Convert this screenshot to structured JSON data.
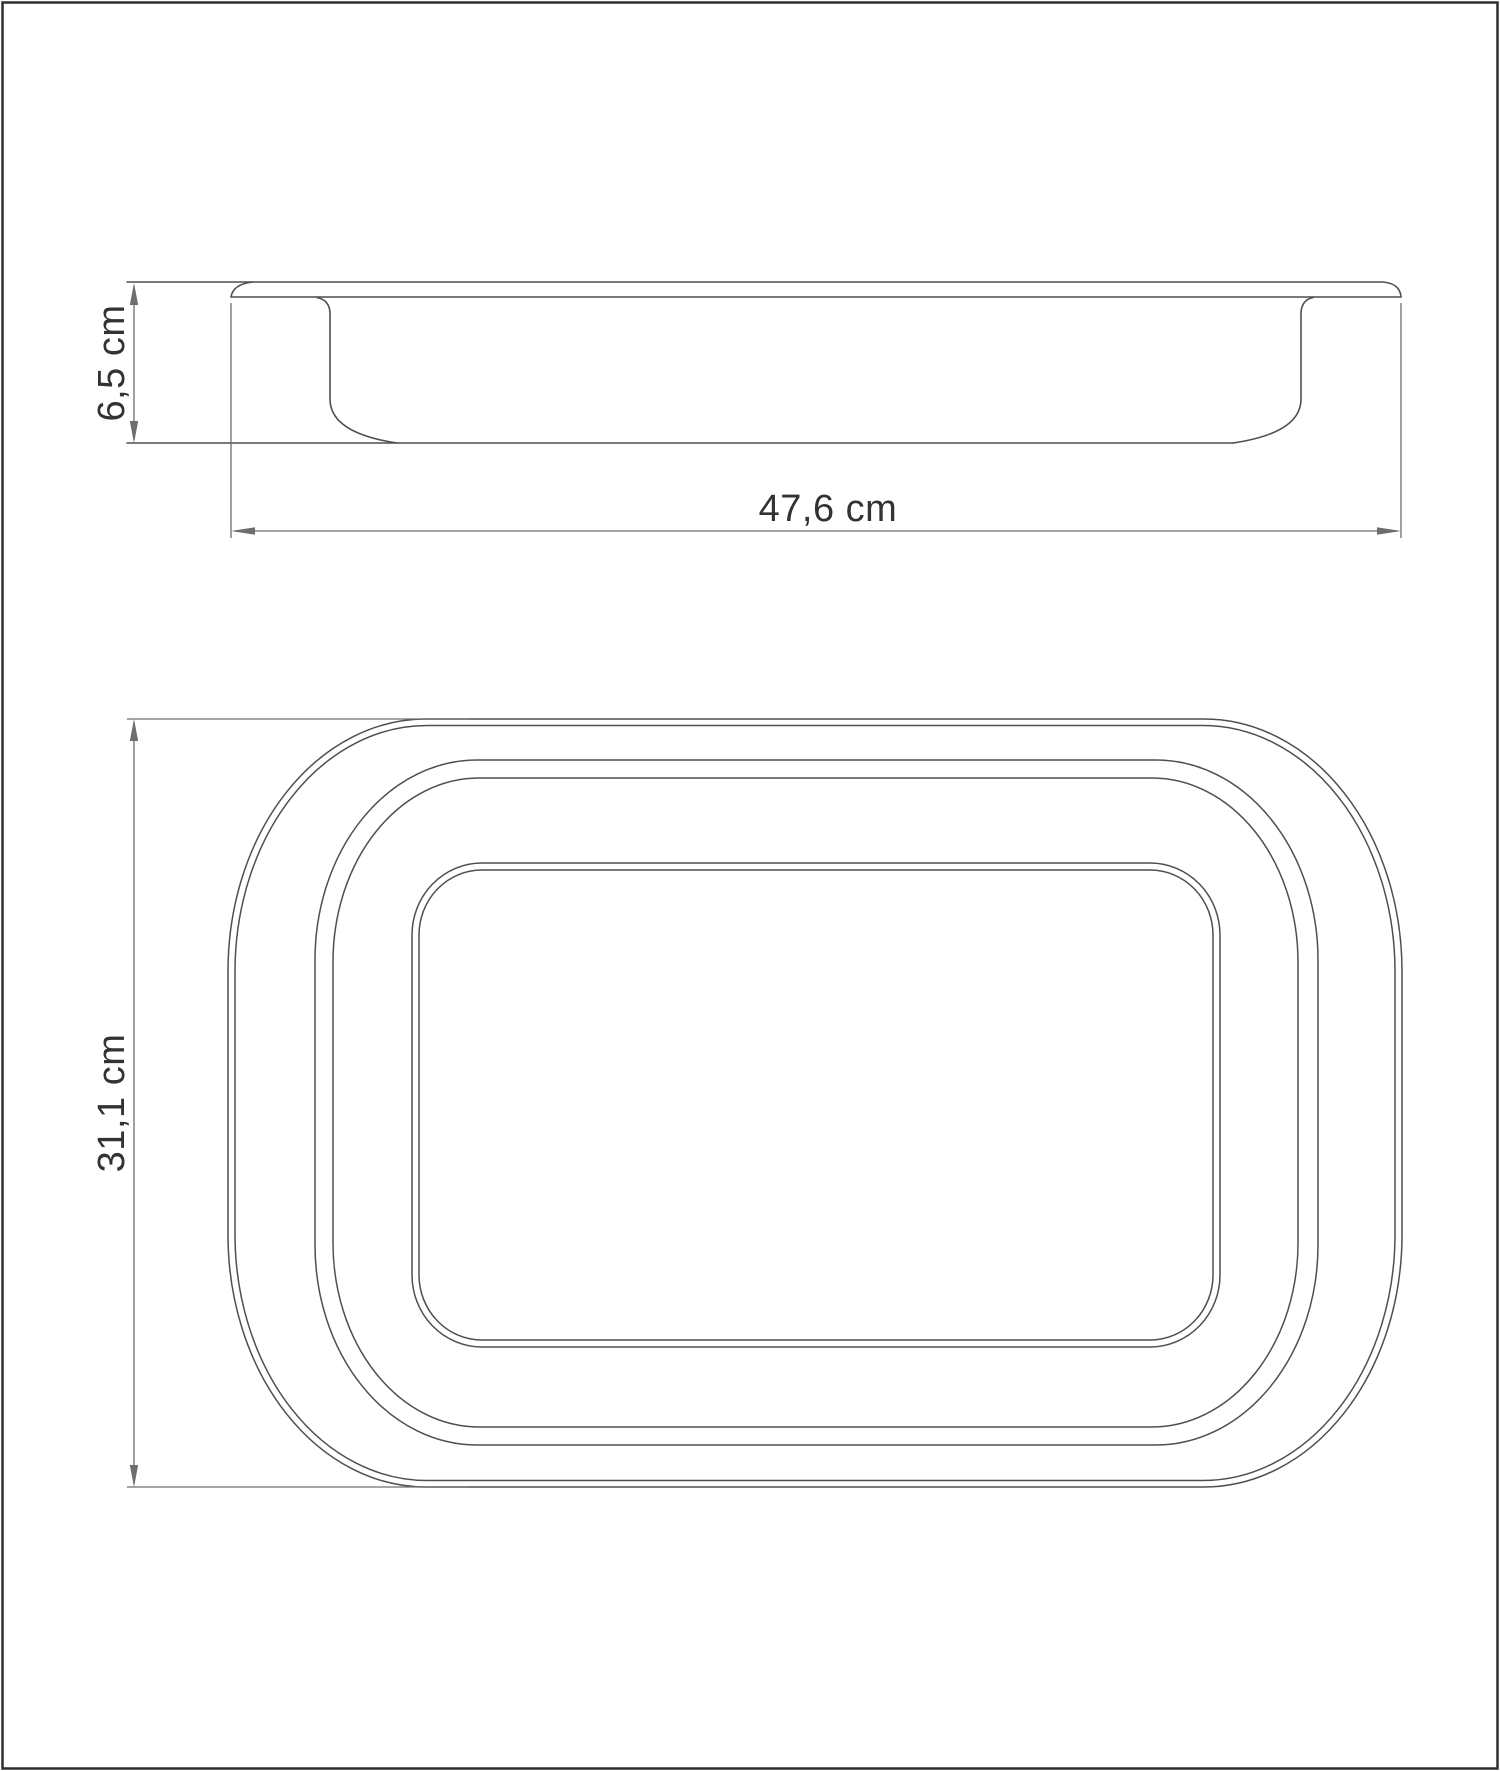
{
  "drawing": {
    "side_view": {
      "height_label": "6,5 cm",
      "width_label": "47,6 cm"
    },
    "top_view": {
      "height_label": "31,1 cm"
    },
    "colors": {
      "outline": "#4f4f4f",
      "dimension": "#6e6e6e",
      "text": "#333333",
      "frame": "#2e2e2e",
      "background": "#ffffff"
    }
  }
}
